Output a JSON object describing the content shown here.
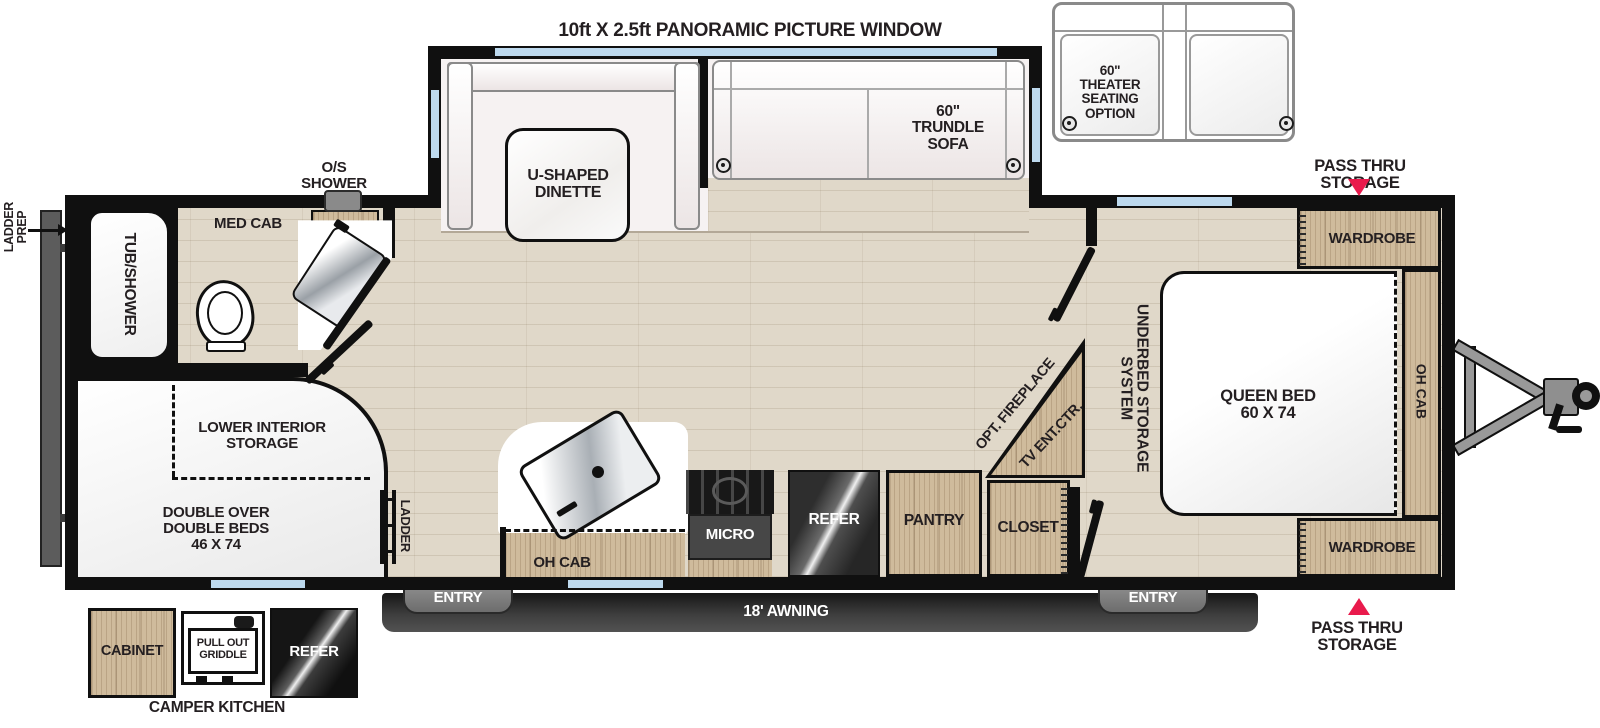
{
  "colors": {
    "accent_red": "#e91a4c",
    "window_blue": "#bdd9ee",
    "wall_black": "#101010",
    "cabinet_wood": "#cfbb9c",
    "floor_wood": "#e0d8c9",
    "appliance_dark": "#3c3c3c"
  },
  "header": {
    "window_title": "10ft X 2.5ft PANORAMIC PICTURE WINDOW"
  },
  "options": {
    "theater_seating": "60\"\nTHEATER\nSEATING\nOPTION"
  },
  "exterior": {
    "pass_thru_top": "PASS THRU STORAGE",
    "pass_thru_bottom": "PASS THRU STORAGE",
    "ladder_prep": "LADDER\nPREP",
    "awning": "18' AWNING",
    "entry_left": "ENTRY",
    "entry_right": "ENTRY"
  },
  "camper_kitchen": {
    "title": "CAMPER KITCHEN",
    "cabinet": "CABINET",
    "griddle": "PULL OUT\nGRIDDLE",
    "refer": "REFER"
  },
  "living": {
    "dinette": "U-SHAPED\nDINETTE",
    "trundle_sofa": "60\"\nTRUNDLE\nSOFA",
    "opt_fireplace": "OPT. FIREPLACE",
    "tv_ent": "TV ENT.CTR."
  },
  "kitchen": {
    "oh_cab": "OH CAB",
    "micro": "MICRO",
    "refer": "REFER",
    "pantry": "PANTRY",
    "closet": "CLOSET"
  },
  "bathroom": {
    "os_shower": "O/S\nSHOWER",
    "med_cab": "MED CAB",
    "tub_shower": "TUB/SHOWER"
  },
  "bunk_room": {
    "lower_storage": "LOWER INTERIOR\nSTORAGE",
    "double_beds": "DOUBLE OVER\nDOUBLE BEDS\n46 X 74",
    "ladder": "LADDER"
  },
  "bedroom": {
    "underbed": "UNDERBED STORAGE SYSTEM",
    "queen_bed": "QUEEN BED\n60 X 74",
    "wardrobe_top": "WARDROBE",
    "wardrobe_bottom": "WARDROBE",
    "oh_cab": "OH CAB"
  }
}
